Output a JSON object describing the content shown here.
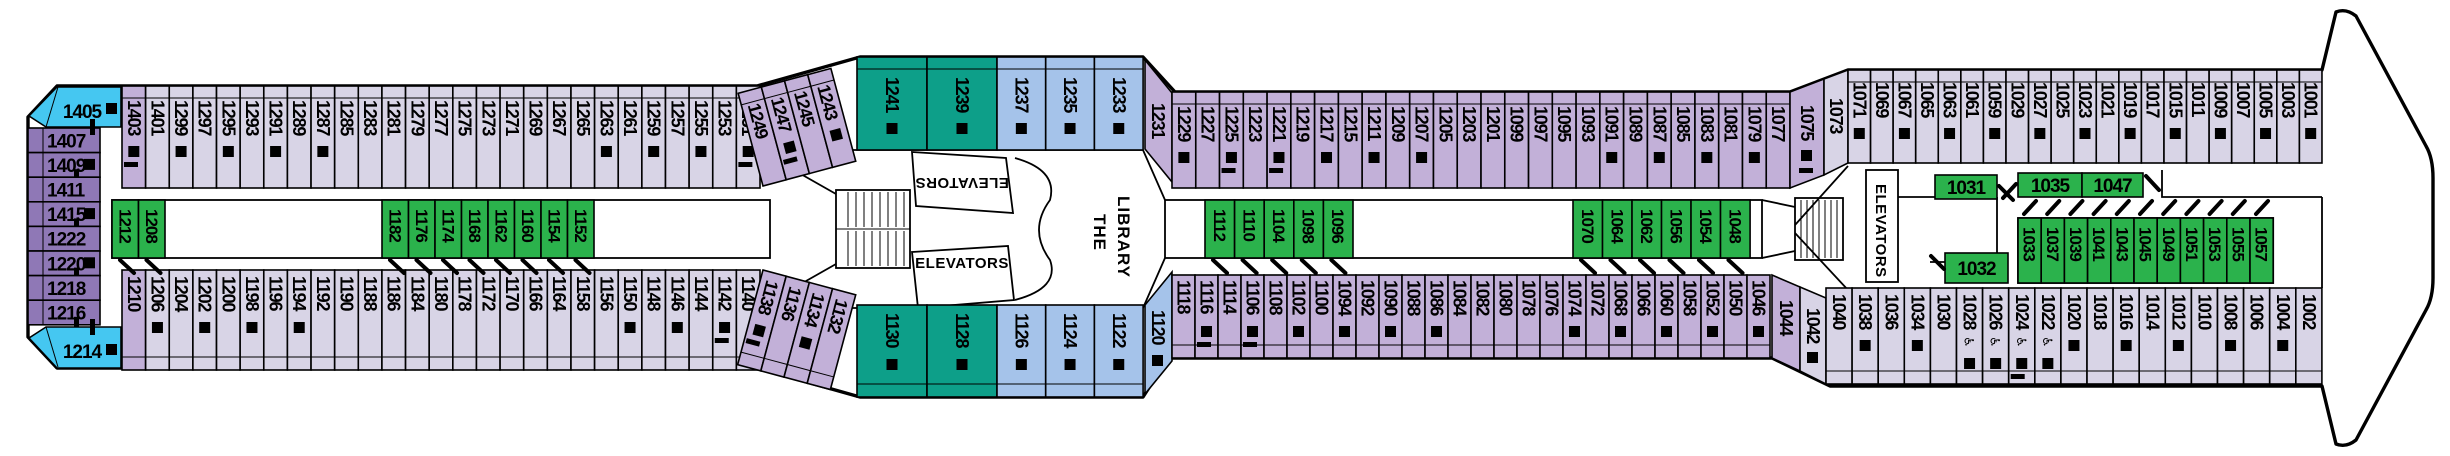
{
  "colors": {
    "pale": "#D8D4E6",
    "mid": "#C2B0D8",
    "purple": "#8F78B6",
    "sky": "#45C7F1",
    "blue": "#A5C3EA",
    "teal": "#0D9F89",
    "green": "#2BB24C",
    "marker": "#000000",
    "box_fill": "#FFFFFF"
  },
  "labels": {
    "elevators": "ELEVATORS",
    "library_line1": "THE",
    "library_line2": "LIBRARY"
  },
  "icons": {
    "wheelchair": "♿"
  },
  "sections": [
    {
      "id": "aft-column",
      "kind": "vcol",
      "x": 28,
      "y": 128,
      "w": 72,
      "ch": 24.6,
      "c": "purple",
      "cabins": [
        {
          "n": "1407"
        },
        {
          "n": "1409",
          "sq": 1,
          "t": 1
        },
        {
          "n": "1411"
        },
        {
          "n": "1415",
          "sq": 1,
          "t": 1
        },
        {
          "n": "1222"
        },
        {
          "n": "1220",
          "sq": 1,
          "t": 1
        },
        {
          "n": "1218"
        },
        {
          "n": "1216",
          "t": 1
        }
      ]
    },
    {
      "id": "corner-aft-top",
      "kind": "corner",
      "c": "sky",
      "points": "57,87 121,87 121,127 46,127 29,116",
      "label": [
        82,
        118
      ],
      "sq": [
        106,
        103
      ],
      "tick": [
        90,
        119,
        5,
        16
      ],
      "line": [
        46,
        127,
        58,
        87
      ],
      "cabins": [
        {
          "n": "1405"
        }
      ]
    },
    {
      "id": "corner-aft-bottom",
      "kind": "corner",
      "c": "sky",
      "points": "46,327 121,327 121,368 57,368 29,338",
      "label": [
        82,
        358
      ],
      "sq": [
        106,
        344
      ],
      "tick": [
        90,
        319,
        5,
        16
      ],
      "line": [
        46,
        327,
        58,
        367
      ],
      "cabins": [
        {
          "n": "1214"
        }
      ]
    },
    {
      "id": "top-row-aft",
      "kind": "vrow",
      "x": 122,
      "y": 86,
      "h": 102,
      "cw": 23.63,
      "bal": "top",
      "yt": 14,
      "c": "pale",
      "cabins": [
        {
          "n": "1403",
          "c": "mid",
          "sq": 1,
          "t": 1
        },
        {
          "n": "1401"
        },
        {
          "n": "1299",
          "sq": 1
        },
        {
          "n": "1297"
        },
        {
          "n": "1295",
          "sq": 1
        },
        {
          "n": "1293"
        },
        {
          "n": "1291",
          "sq": 1
        },
        {
          "n": "1289"
        },
        {
          "n": "1287",
          "sq": 1
        },
        {
          "n": "1285"
        },
        {
          "n": "1283"
        },
        {
          "n": "1281"
        },
        {
          "n": "1279"
        },
        {
          "n": "1277"
        },
        {
          "n": "1275"
        },
        {
          "n": "1273"
        },
        {
          "n": "1271"
        },
        {
          "n": "1269"
        },
        {
          "n": "1267"
        },
        {
          "n": "1265"
        },
        {
          "n": "1263",
          "sq": 1
        },
        {
          "n": "1261"
        },
        {
          "n": "1259",
          "sq": 1
        },
        {
          "n": "1257"
        },
        {
          "n": "1255",
          "sq": 1
        },
        {
          "n": "1253"
        },
        {
          "n": "1251",
          "sq": 1,
          "t": 1
        }
      ]
    },
    {
      "id": "top-row-diagonal",
      "kind": "vrow",
      "x": 763,
      "y": 90,
      "h": 96,
      "cw": 24,
      "bal": "top",
      "yt": 14,
      "c": "mid",
      "rot": -15,
      "pivot": [
        763,
        186
      ],
      "cabins": [
        {
          "n": "1249"
        },
        {
          "n": "1247",
          "sq": 1,
          "t": 1
        },
        {
          "n": "1245"
        },
        {
          "n": "1243",
          "sq": 1
        }
      ]
    },
    {
      "id": "top-suites",
      "kind": "vrow",
      "x": 857,
      "y": 57,
      "h": 93,
      "cw": 70,
      "bal": "top",
      "yt": 20,
      "c": "teal",
      "cabins": [
        {
          "n": "1241",
          "sq": 1
        },
        {
          "n": "1239",
          "sq": 1
        }
      ]
    },
    {
      "id": "top-blue",
      "kind": "vrow",
      "x": 997,
      "y": 57,
      "h": 93,
      "cw": 48.7,
      "bal": "top",
      "yt": 20,
      "c": "blue",
      "cabins": [
        {
          "n": "1237",
          "sq": 1
        },
        {
          "n": "1235",
          "sq": 1
        },
        {
          "n": "1233",
          "sq": 1
        }
      ]
    },
    {
      "id": "cabin-1231",
      "kind": "polycab",
      "c": "mid",
      "points": "1145,60 1172,93 1172,182 1145,149",
      "label": [
        1152,
        103
      ],
      "cabins": [
        {
          "n": "1231"
        }
      ]
    },
    {
      "id": "top-row-mid",
      "kind": "vrow",
      "x": 1172,
      "y": 92,
      "h": 96,
      "cw": 23.77,
      "bal": "top",
      "yt": 14,
      "c": "mid",
      "cabins": [
        {
          "n": "1229",
          "sq": 1
        },
        {
          "n": "1227"
        },
        {
          "n": "1225",
          "sq": 1,
          "t": 1
        },
        {
          "n": "1223"
        },
        {
          "n": "1221",
          "sq": 1,
          "t": 1
        },
        {
          "n": "1219"
        },
        {
          "n": "1217",
          "sq": 1
        },
        {
          "n": "1215"
        },
        {
          "n": "1211",
          "sq": 1
        },
        {
          "n": "1209"
        },
        {
          "n": "1207",
          "sq": 1
        },
        {
          "n": "1205"
        },
        {
          "n": "1203"
        },
        {
          "n": "1201"
        },
        {
          "n": "1099"
        },
        {
          "n": "1097"
        },
        {
          "n": "1095"
        },
        {
          "n": "1093"
        },
        {
          "n": "1091",
          "sq": 1
        },
        {
          "n": "1089"
        },
        {
          "n": "1087",
          "sq": 1
        },
        {
          "n": "1085"
        },
        {
          "n": "1083",
          "sq": 1
        },
        {
          "n": "1081"
        },
        {
          "n": "1079",
          "sq": 1
        },
        {
          "n": "1077"
        }
      ]
    },
    {
      "id": "cabin-1075",
      "kind": "polycab",
      "c": "mid",
      "points": "1790,92 1824,79 1824,175 1790,188",
      "label": [
        1801,
        105
      ],
      "sq": [
        1801,
        150
      ],
      "tick": [
        1799,
        168,
        14,
        5
      ],
      "cabins": [
        {
          "n": "1075"
        }
      ]
    },
    {
      "id": "cabin-1073",
      "kind": "polycab",
      "c": "pale",
      "points": "1824,79 1848,70 1848,163 1824,175",
      "label": [
        1830,
        98
      ],
      "cabins": [
        {
          "n": "1073"
        }
      ]
    },
    {
      "id": "top-row-forward",
      "kind": "vrow",
      "x": 1848,
      "y": 70,
      "h": 93,
      "cw": 22.57,
      "bal": "top",
      "yt": 12,
      "c": "pale",
      "cabins": [
        {
          "n": "1071",
          "sq": 1
        },
        {
          "n": "1069"
        },
        {
          "n": "1067",
          "sq": 1
        },
        {
          "n": "1065"
        },
        {
          "n": "1063",
          "sq": 1
        },
        {
          "n": "1061"
        },
        {
          "n": "1059",
          "sq": 1
        },
        {
          "n": "1029"
        },
        {
          "n": "1027",
          "sq": 1
        },
        {
          "n": "1025"
        },
        {
          "n": "1023",
          "sq": 1
        },
        {
          "n": "1021"
        },
        {
          "n": "1019",
          "sq": 1
        },
        {
          "n": "1017"
        },
        {
          "n": "1015",
          "sq": 1
        },
        {
          "n": "1011"
        },
        {
          "n": "1009",
          "sq": 1
        },
        {
          "n": "1007"
        },
        {
          "n": "1005",
          "sq": 1
        },
        {
          "n": "1003"
        },
        {
          "n": "1001",
          "sq": 1
        }
      ]
    },
    {
      "id": "bottom-row-aft",
      "kind": "vrow",
      "x": 122,
      "y": 270,
      "h": 100,
      "cw": 23.63,
      "bal": "bottom",
      "yt": 6,
      "c": "pale",
      "cabins": [
        {
          "n": "1210",
          "c": "mid"
        },
        {
          "n": "1206",
          "sq": 1
        },
        {
          "n": "1204"
        },
        {
          "n": "1202",
          "sq": 1
        },
        {
          "n": "1200"
        },
        {
          "n": "1198",
          "sq": 1
        },
        {
          "n": "1196"
        },
        {
          "n": "1194",
          "sq": 1
        },
        {
          "n": "1192"
        },
        {
          "n": "1190"
        },
        {
          "n": "1188"
        },
        {
          "n": "1186"
        },
        {
          "n": "1184"
        },
        {
          "n": "1180"
        },
        {
          "n": "1178"
        },
        {
          "n": "1172"
        },
        {
          "n": "1170"
        },
        {
          "n": "1166"
        },
        {
          "n": "1164"
        },
        {
          "n": "1158"
        },
        {
          "n": "1156"
        },
        {
          "n": "1150",
          "sq": 1
        },
        {
          "n": "1148"
        },
        {
          "n": "1146",
          "sq": 1
        },
        {
          "n": "1144"
        },
        {
          "n": "1142",
          "sq": 1,
          "t": 1
        },
        {
          "n": "1140"
        }
      ]
    },
    {
      "id": "bottom-row-diagonal",
      "kind": "vrow",
      "x": 763,
      "y": 270,
      "h": 98,
      "cw": 24,
      "bal": "bottom",
      "yt": 8,
      "c": "mid",
      "rot": 15,
      "pivot": [
        763,
        270
      ],
      "cabins": [
        {
          "n": "1138",
          "sq": 1,
          "t": 1
        },
        {
          "n": "1136"
        },
        {
          "n": "1134",
          "sq": 1
        },
        {
          "n": "1132"
        }
      ]
    },
    {
      "id": "bottom-suites",
      "kind": "vrow",
      "x": 857,
      "y": 305,
      "h": 92,
      "cw": 70,
      "bal": "bottom",
      "yt": 8,
      "c": "teal",
      "cabins": [
        {
          "n": "1130",
          "sq": 1
        },
        {
          "n": "1128",
          "sq": 1
        }
      ]
    },
    {
      "id": "bottom-blue",
      "kind": "vrow",
      "x": 997,
      "y": 305,
      "h": 92,
      "cw": 48.7,
      "bal": "bottom",
      "yt": 8,
      "c": "blue",
      "cabins": [
        {
          "n": "1126",
          "sq": 1
        },
        {
          "n": "1124",
          "sq": 1
        },
        {
          "n": "1122",
          "sq": 1
        }
      ]
    },
    {
      "id": "cabin-1120",
      "kind": "polycab",
      "c": "blue",
      "points": "1145,394 1172,361 1172,272 1145,305",
      "label": [
        1152,
        310
      ],
      "sq": [
        1152,
        355
      ],
      "cabins": [
        {
          "n": "1120"
        }
      ]
    },
    {
      "id": "bottom-row-mid",
      "kind": "vrow",
      "x": 1172,
      "y": 275,
      "h": 83,
      "cw": 23.0,
      "bal": "bottom",
      "yt": 5,
      "c": "mid",
      "cabins": [
        {
          "n": "1118"
        },
        {
          "n": "1116",
          "sq": 1,
          "t": 1
        },
        {
          "n": "1114"
        },
        {
          "n": "1106",
          "sq": 1,
          "t": 1
        },
        {
          "n": "1108"
        },
        {
          "n": "1102",
          "sq": 1
        },
        {
          "n": "1100"
        },
        {
          "n": "1094",
          "sq": 1
        },
        {
          "n": "1092"
        },
        {
          "n": "1090",
          "sq": 1
        },
        {
          "n": "1088"
        },
        {
          "n": "1086",
          "sq": 1
        },
        {
          "n": "1084"
        },
        {
          "n": "1082"
        },
        {
          "n": "1080"
        },
        {
          "n": "1078"
        },
        {
          "n": "1076"
        },
        {
          "n": "1074",
          "sq": 1
        },
        {
          "n": "1072"
        },
        {
          "n": "1068",
          "sq": 1
        },
        {
          "n": "1066"
        },
        {
          "n": "1060",
          "sq": 1
        },
        {
          "n": "1058"
        },
        {
          "n": "1052",
          "sq": 1
        },
        {
          "n": "1050"
        },
        {
          "n": "1046",
          "sq": 1
        }
      ]
    },
    {
      "id": "cabin-1044",
      "kind": "polycab",
      "c": "mid",
      "points": "1772,275 1800,287 1800,371 1772,358",
      "label": [
        1780,
        300
      ],
      "cabins": [
        {
          "n": "1044"
        }
      ]
    },
    {
      "id": "cabin-1042",
      "kind": "polycab",
      "c": "pale",
      "points": "1800,287 1826,298 1826,384 1800,371",
      "label": [
        1807,
        308
      ],
      "sq": [
        1807,
        352
      ],
      "cabins": [
        {
          "n": "1042"
        }
      ]
    },
    {
      "id": "bottom-row-forward",
      "kind": "vrow",
      "x": 1826,
      "y": 288,
      "h": 96,
      "cw": 26.1,
      "bal": "bottom",
      "yt": 6,
      "c": "pale",
      "cabins": [
        {
          "n": "1040"
        },
        {
          "n": "1038",
          "sq": 1
        },
        {
          "n": "1036"
        },
        {
          "n": "1034",
          "sq": 1
        },
        {
          "n": "1030"
        },
        {
          "n": "1028",
          "sq": 1,
          "wc": 1
        },
        {
          "n": "1026",
          "sq": 1,
          "wc": 1
        },
        {
          "n": "1024",
          "sq": 1,
          "wc": 1,
          "t": 1
        },
        {
          "n": "1022",
          "sq": 1,
          "wc": 1
        },
        {
          "n": "1020",
          "sq": 1
        },
        {
          "n": "1018"
        },
        {
          "n": "1016",
          "sq": 1
        },
        {
          "n": "1014"
        },
        {
          "n": "1012",
          "sq": 1
        },
        {
          "n": "1010"
        },
        {
          "n": "1008",
          "sq": 1
        },
        {
          "n": "1006"
        },
        {
          "n": "1004",
          "sq": 1
        },
        {
          "n": "1002"
        }
      ]
    },
    {
      "id": "inside-aft-green",
      "kind": "greenrow",
      "box": [
        112,
        200,
        658,
        58
      ],
      "cw": 26.5,
      "y": 200,
      "h": 58,
      "door": "b",
      "cells": [
        {
          "n": "1212",
          "x": 112
        },
        {
          "n": "1208",
          "x": 138.5
        },
        {
          "n": "1182",
          "x": 382
        },
        {
          "n": "1176",
          "x": 408.5
        },
        {
          "n": "1174",
          "x": 435
        },
        {
          "n": "1168",
          "x": 461.5
        },
        {
          "n": "1162",
          "x": 488
        },
        {
          "n": "1160",
          "x": 514.5
        },
        {
          "n": "1154",
          "x": 541
        },
        {
          "n": "1152",
          "x": 567.5
        }
      ]
    },
    {
      "id": "inside-mid-green",
      "kind": "greenrow",
      "box": [
        1165,
        200,
        597,
        58
      ],
      "cw": 29.6,
      "y": 200,
      "h": 58,
      "door": "b",
      "cells": [
        {
          "n": "1112",
          "x": 1205
        },
        {
          "n": "1110",
          "x": 1234.6
        },
        {
          "n": "1104",
          "x": 1264.2
        },
        {
          "n": "1098",
          "x": 1293.8
        },
        {
          "n": "1096",
          "x": 1323.4
        },
        {
          "n": "1070",
          "x": 1573
        },
        {
          "n": "1064",
          "x": 1602.5
        },
        {
          "n": "1062",
          "x": 1632
        },
        {
          "n": "1056",
          "x": 1661.5
        },
        {
          "n": "1054",
          "x": 1691
        },
        {
          "n": "1048",
          "x": 1720.5
        }
      ]
    },
    {
      "id": "inside-forward-suites",
      "kind": "greenh",
      "cells": [
        {
          "n": "1031",
          "x": 1935,
          "y": 175,
          "w": 62,
          "h": 24,
          "door": [
            1999,
            186,
            2013,
            200
          ]
        },
        {
          "n": "1035",
          "x": 2018,
          "y": 173,
          "w": 64,
          "h": 24,
          "door": [
            2016,
            184,
            2003,
            198
          ]
        },
        {
          "n": "1047",
          "x": 2082,
          "y": 173,
          "w": 61,
          "h": 24,
          "door": [
            2146,
            176,
            2159,
            190
          ]
        },
        {
          "n": "1032",
          "x": 1945,
          "y": 253,
          "w": 63,
          "h": 30,
          "door": [
            1931,
            256,
            1944,
            269
          ]
        }
      ]
    },
    {
      "id": "inside-forward-row",
      "kind": "greenrow",
      "box": [
        2018,
        218,
        255.2,
        65
      ],
      "cw": 23.2,
      "y": 218,
      "h": 65,
      "door": "t",
      "cells": [
        {
          "n": "1033",
          "x": 2018
        },
        {
          "n": "1037",
          "x": 2041.2
        },
        {
          "n": "1039",
          "x": 2064.4
        },
        {
          "n": "1041",
          "x": 2087.6
        },
        {
          "n": "1043",
          "x": 2110.8
        },
        {
          "n": "1045",
          "x": 2134
        },
        {
          "n": "1049",
          "x": 2157.2
        },
        {
          "n": "1051",
          "x": 2180.4
        },
        {
          "n": "1053",
          "x": 2203.6
        },
        {
          "n": "1055",
          "x": 2226.8
        },
        {
          "n": "1057",
          "x": 2250
        }
      ]
    }
  ]
}
